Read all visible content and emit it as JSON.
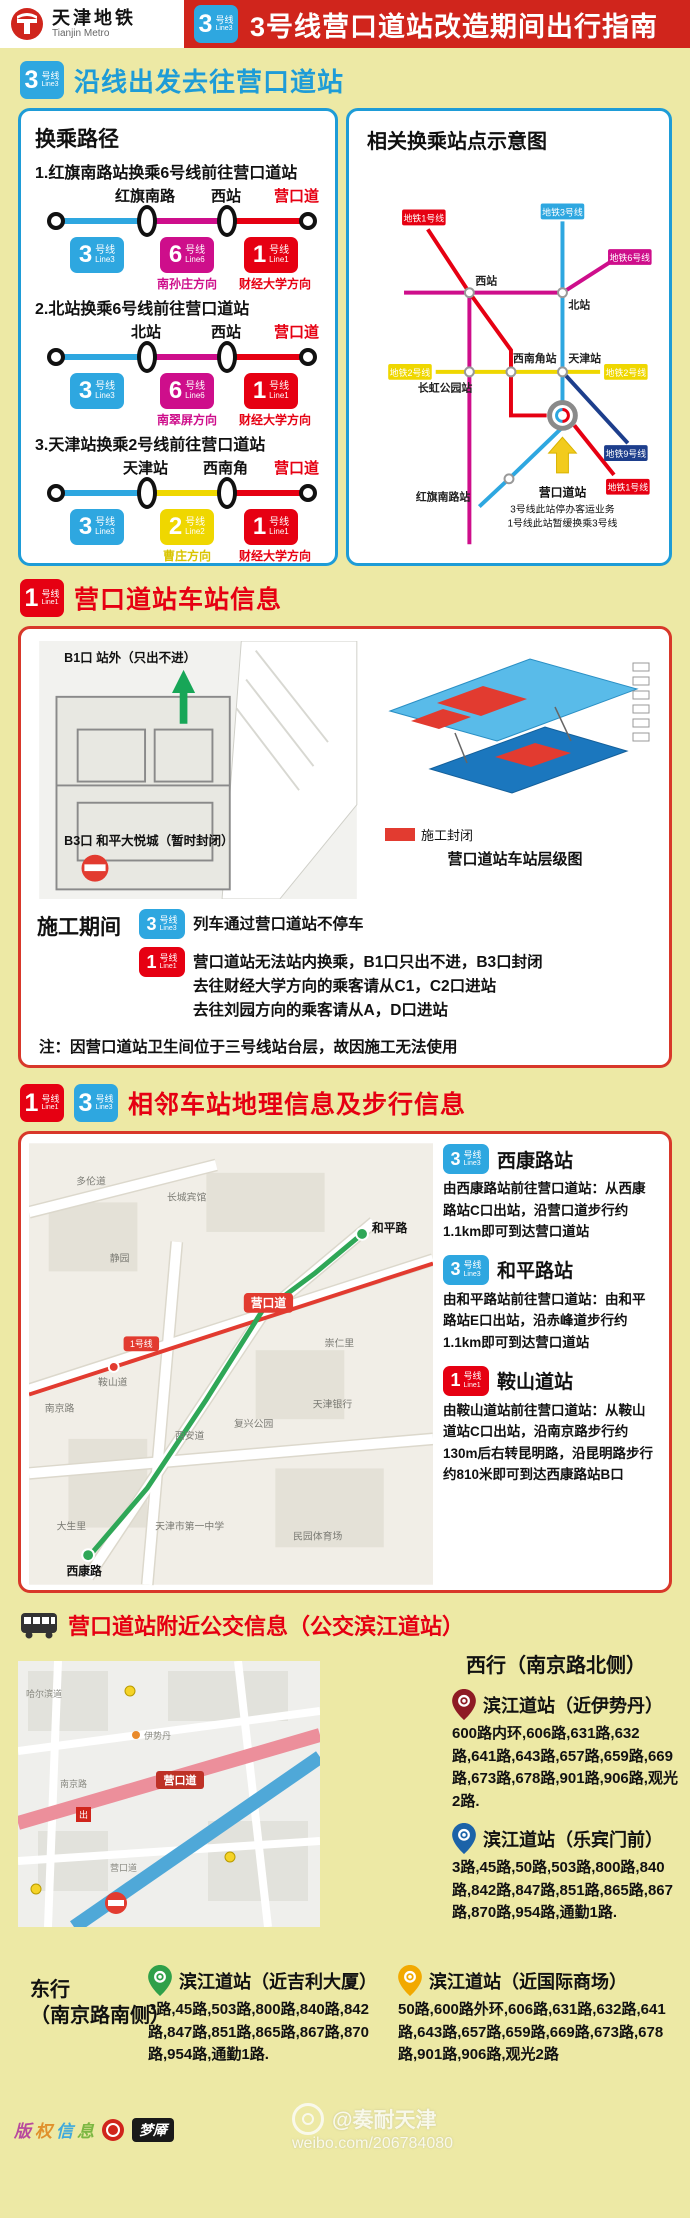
{
  "header": {
    "logo_cn": "天津地铁",
    "logo_en": "Tianjin Metro",
    "badge": {
      "num": "3",
      "cn": "号线",
      "en": "Line3"
    },
    "title": "3号线营口道站改造期间出行指南"
  },
  "s1": {
    "badge": {
      "num": "3",
      "cn": "号线",
      "en": "Line3"
    },
    "title": "沿线出发去往营口道站",
    "left": {
      "heading": "换乘路径",
      "routes": [
        {
          "title": "1.红旗南路站换乘6号线前往营口道站",
          "s1": "红旗南路",
          "s2": "西站",
          "dest": "营口道",
          "leg1": {
            "num": "3",
            "cn": "号线",
            "en": "Line3"
          },
          "leg2": {
            "num": "6",
            "cn": "号线",
            "en": "Line6",
            "dir": "南孙庄方向"
          },
          "leg3": {
            "num": "1",
            "cn": "号线",
            "en": "Line1",
            "dir": "财经大学方向"
          }
        },
        {
          "title": "2.北站换乘6号线前往营口道站",
          "s1": "北站",
          "s2": "西站",
          "dest": "营口道",
          "leg1": {
            "num": "3",
            "cn": "号线",
            "en": "Line3"
          },
          "leg2": {
            "num": "6",
            "cn": "号线",
            "en": "Line6",
            "dir": "南翠屏方向"
          },
          "leg3": {
            "num": "1",
            "cn": "号线",
            "en": "Line1",
            "dir": "财经大学方向"
          }
        },
        {
          "title": "3.天津站换乘2号线前往营口道站",
          "s1": "天津站",
          "s2": "西南角",
          "dest": "营口道",
          "leg1": {
            "num": "3",
            "cn": "号线",
            "en": "Line3"
          },
          "leg2": {
            "num": "2",
            "cn": "号线",
            "en": "Line2",
            "dir": "曹庄方向"
          },
          "leg3": {
            "num": "1",
            "cn": "号线",
            "en": "Line1",
            "dir": "财经大学方向"
          }
        }
      ]
    },
    "right": {
      "heading": "相关换乘站点示意图",
      "labels": {
        "xizhan": "西站",
        "beizhan": "北站",
        "xinanjiao": "西南角站",
        "tianjin": "天津站",
        "changhong": "长虹公园站",
        "hongqi": "红旗南路站"
      },
      "badges": {
        "l1": "地铁1号线",
        "l3": "地铁3号线",
        "l6": "地铁6号线",
        "l2a": "地铁2号线",
        "l2b": "地铁2号线",
        "l9": "地铁9号线",
        "l1b": "地铁1号线"
      },
      "note1": "营口道站",
      "note2": "3号线此站停办客运业务",
      "note3": "1号线此站暂缓换乘3号线"
    }
  },
  "s2": {
    "badge": {
      "num": "1",
      "cn": "号线",
      "en": "Line1"
    },
    "title": "营口道站车站信息",
    "plan": {
      "b1": "B1口 站外（只出不进）",
      "b3": "B3口 和平大悦城（暂时封闭）"
    },
    "legend": "施工封闭",
    "caption": "营口道站车站层级图",
    "period_label": "施工期间",
    "row1": {
      "badge": {
        "num": "3",
        "cn": "号线",
        "en": "Line3"
      },
      "text": "列车通过营口道站不停车"
    },
    "row2": {
      "badge": {
        "num": "1",
        "cn": "号线",
        "en": "Line1"
      },
      "l1": "营口道站无法站内换乘，B1口只出不进，B3口封闭",
      "l2": "去往财经大学方向的乘客请从C1，C2口进站",
      "l3": "去往刘园方向的乘客请从A，D口进站"
    },
    "note": "注：因营口道站卫生间位于三号线站台层，故因施工无法使用"
  },
  "s3": {
    "badge1": {
      "num": "1",
      "cn": "号线",
      "en": "Line1"
    },
    "badge3": {
      "num": "3",
      "cn": "号线",
      "en": "Line3"
    },
    "title": "相邻车站地理信息及步行信息",
    "map_labels": [
      "多伦道",
      "长城宾馆",
      "静园",
      "鞍山道",
      "南京路",
      "西安道",
      "复兴公园",
      "天津银行",
      "崇仁里",
      "天津市第一中学",
      "民园体育场",
      "大生里"
    ],
    "stations": {
      "yingkoudao": "营口道",
      "xikanglu": "西康路",
      "hepinglu": "和平路",
      "line1": "1号线"
    },
    "items": [
      {
        "badge": {
          "num": "3",
          "cn": "号线",
          "en": "Line3"
        },
        "name": "西康路站",
        "desc": "由西康路站前往营口道站：从西康路站C口出站，沿营口道步行约1.1km即可到达营口道站"
      },
      {
        "badge": {
          "num": "3",
          "cn": "号线",
          "en": "Line3"
        },
        "name": "和平路站",
        "desc": "由和平路站前往营口道站：由和平路站E口出站，沿赤峰道步行约1.1km即可到达营口道站"
      },
      {
        "badge": {
          "num": "1",
          "cn": "号线",
          "en": "Line1"
        },
        "name": "鞍山道站",
        "desc": "由鞍山道站前往营口道站：从鞍山道站C口出站，沿南京路步行约130m后右转昆明路，沿昆明路步行约810米即可到达西康路站B口"
      }
    ]
  },
  "s4": {
    "title": "营口道站附近公交信息（公交滨江道站）",
    "west_label": "西行（南京路北侧）",
    "east_label1": "东行",
    "east_label2": "（南京路南侧）",
    "map_labels": {
      "l0": "哈尔滨道",
      "l1": "南京路",
      "l2": "营口道",
      "l3": "伊势丹"
    },
    "map_station": "营口道",
    "map_exit": "出",
    "stops": [
      {
        "name": "滨江道站（近伊势丹）",
        "routes": "600路内环,606路,631路,632路,641路,643路,657路,659路,669路,673路,678路,901路,906路,观光2路."
      },
      {
        "name": "滨江道站（乐宾门前）",
        "routes": "3路,45路,50路,503路,800路,840路,842路,847路,851路,865路,867路,870路,954路,通勤1路."
      },
      {
        "name": "滨江道站（近吉利大厦）",
        "routes": "3路,45路,503路,800路,840路,842路,847路,851路,865路,867路,870路,954路,通勤1路."
      },
      {
        "name": "滨江道站（近国际商场）",
        "routes": "50路,600路外环,606路,631路,632路,641路,643路,657路,659路,669路,673路,678路,901路,906路,观光2路"
      }
    ]
  },
  "footer": {
    "c1": "版",
    "c2": "权",
    "c3": "信",
    "c4": "息",
    "logo2": "梦厣",
    "wm1": "@奏耐天津",
    "wm2": "weibo.com/206784080"
  }
}
